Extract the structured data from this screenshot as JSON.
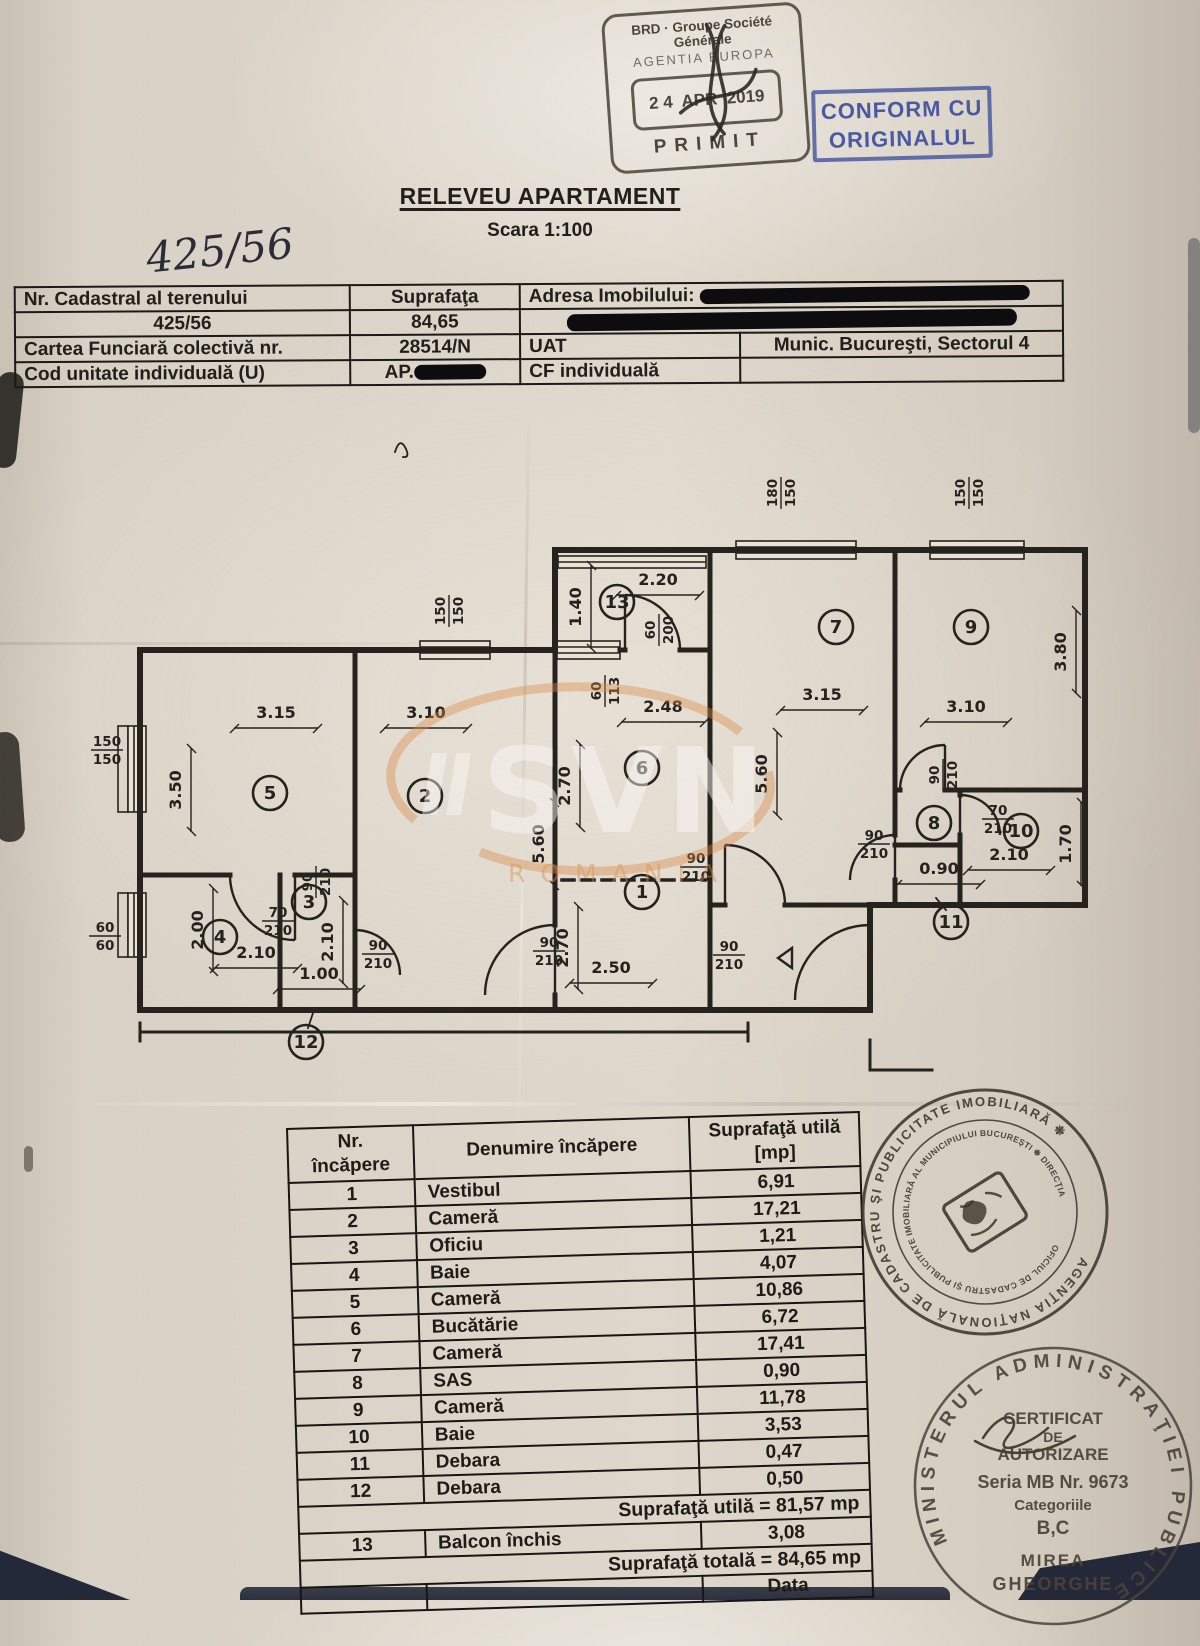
{
  "document": {
    "title": "RELEVEU APARTAMENT",
    "subtitle": "Scara 1:100",
    "handwritten_number": "425/56"
  },
  "stamps": {
    "brd": {
      "org": "BRD · Groupe Société Générale",
      "agency": "AGENTIA EUROPA",
      "date": "2 4  APR  2019",
      "status": "PRIMIT"
    },
    "conform": {
      "line1": "CONFORM CU",
      "line2": "ORIGINALUL",
      "color": "#3c4ea0"
    },
    "ocpi": {
      "outer_text": "AGENŢIA NAŢIONALĂ DE CADASTRU ŞI PUBLICITATE IMOBILIARĂ ❉",
      "inner_text": "OFICIUL DE CADASTRU ŞI PUBLICITATE IMOBILIARĂ AL MUNICIPIULUI BUCUREŞTI ❉ DIRECŢIA"
    },
    "minister": {
      "ring_text": "MINISTERUL ADMINISTRAŢIEI PUBLICE",
      "cert_line1": "CERTIFICAT",
      "cert_line2": "DE",
      "cert_line3": "AUTORIZARE",
      "seria": "Seria MB Nr. 9673",
      "categorii_label": "Categoriile",
      "categorii": "B,C",
      "name1": "MIREA",
      "name2": "GHEORGHE"
    }
  },
  "info_table": {
    "r1c1": "Nr. Cadastral al terenului",
    "r1c2": "Suprafaţa",
    "r1c3": "Adresa Imobilului:",
    "r2c1": "425/56",
    "r2c2": "84,65",
    "r3c1": "Cartea Funciară colectivă nr.",
    "r3c2": "28514/N",
    "r3c3": "UAT",
    "r3c4": "Munic. Bucureşti, Sectorul 4",
    "r4c1": "Cod unitate individuală (U)",
    "r4c2": "AP.",
    "r4c3": "CF individuală",
    "r4c4": ""
  },
  "room_table": {
    "header_nr_1": "Nr.",
    "header_nr_2": "încăpere",
    "header_name": "Denumire încăpere",
    "header_area_1": "Suprafaţă utilă",
    "header_area_2": "[mp]",
    "rows": [
      [
        "1",
        "Vestibul",
        "6,91"
      ],
      [
        "2",
        "Cameră",
        "17,21"
      ],
      [
        "3",
        "Oficiu",
        "1,21"
      ],
      [
        "4",
        "Baie",
        "4,07"
      ],
      [
        "5",
        "Cameră",
        "10,86"
      ],
      [
        "6",
        "Bucătărie",
        "6,72"
      ],
      [
        "7",
        "Cameră",
        "17,41"
      ],
      [
        "8",
        "SAS",
        "0,90"
      ],
      [
        "9",
        "Cameră",
        "11,78"
      ],
      [
        "10",
        "Baie",
        "3,53"
      ],
      [
        "11",
        "Debara",
        "0,47"
      ],
      [
        "12",
        "Debara",
        "0,50"
      ]
    ],
    "subtotal": "Suprafaţă utilă = 81,57 mp",
    "row13": [
      "13",
      "Balcon închis",
      "3,08"
    ],
    "total": "Suprafaţă totală = 84,65 mp",
    "footer": "Data"
  },
  "plan": {
    "watermark": {
      "text": "SVN",
      "sub": "ROMANIA",
      "accent": "#d98a45"
    },
    "rooms": [
      {
        "n": "5",
        "x": 190,
        "y": 363
      },
      {
        "n": "2",
        "x": 345,
        "y": 366
      },
      {
        "n": "6",
        "x": 562,
        "y": 338
      },
      {
        "n": "1",
        "x": 562,
        "y": 462
      },
      {
        "n": "4",
        "x": 140,
        "y": 507
      },
      {
        "n": "3",
        "x": 229,
        "y": 472
      },
      {
        "n": "13",
        "x": 537,
        "y": 172
      },
      {
        "n": "7",
        "x": 756,
        "y": 197
      },
      {
        "n": "9",
        "x": 891,
        "y": 197
      },
      {
        "n": "8",
        "x": 854,
        "y": 393
      },
      {
        "n": "10",
        "x": 941,
        "y": 401
      },
      {
        "n": "11",
        "x": 871,
        "y": 492
      },
      {
        "n": "12",
        "x": 226,
        "y": 612
      }
    ],
    "dims": [
      {
        "t": "3.15",
        "x": 196,
        "y": 288,
        "r": 0,
        "l": 1
      },
      {
        "t": "3.10",
        "x": 346,
        "y": 288,
        "r": 0,
        "l": 1
      },
      {
        "t": "2.48",
        "x": 583,
        "y": 282,
        "r": 0,
        "l": 1
      },
      {
        "t": "3.15",
        "x": 742,
        "y": 270,
        "r": 0,
        "l": 1
      },
      {
        "t": "3.10",
        "x": 886,
        "y": 282,
        "r": 0,
        "l": 1
      },
      {
        "t": "2.20",
        "x": 578,
        "y": 155,
        "r": 0,
        "l": 1
      },
      {
        "t": "2.50",
        "x": 531,
        "y": 543,
        "r": 0,
        "l": 1
      },
      {
        "t": "2.10",
        "x": 176,
        "y": 528,
        "r": 0,
        "l": 1
      },
      {
        "t": "1.00",
        "x": 239,
        "y": 549,
        "r": 0,
        "l": 1
      },
      {
        "t": "0.90",
        "x": 859,
        "y": 444,
        "r": 0,
        "l": 1
      },
      {
        "t": "2.10",
        "x": 929,
        "y": 430,
        "r": 0,
        "l": 1
      },
      {
        "t": "3.50",
        "x": 101,
        "y": 360,
        "r": -90,
        "l": 1
      },
      {
        "t": "5.60",
        "x": 464,
        "y": 414,
        "r": -90,
        "l": 1
      },
      {
        "t": "2.70",
        "x": 490,
        "y": 356,
        "r": -90,
        "l": 1
      },
      {
        "t": "2.70",
        "x": 488,
        "y": 518,
        "r": -90,
        "l": 1
      },
      {
        "t": "2.00",
        "x": 123,
        "y": 500,
        "r": -90,
        "l": 1
      },
      {
        "t": "2.10",
        "x": 253,
        "y": 512,
        "r": -90,
        "l": 1
      },
      {
        "t": "1.40",
        "x": 501,
        "y": 177,
        "r": -90,
        "l": 1
      },
      {
        "t": "5.60",
        "x": 687,
        "y": 344,
        "r": -90,
        "l": 1
      },
      {
        "t": "3.80",
        "x": 986,
        "y": 222,
        "r": -90,
        "l": 1
      },
      {
        "t": "1.70",
        "x": 991,
        "y": 414,
        "r": -90,
        "l": 1
      }
    ],
    "fracs": [
      {
        "a": "150",
        "b": "150",
        "x": 27,
        "y": 320,
        "r": 0
      },
      {
        "a": "60",
        "b": "60",
        "x": 25,
        "y": 506,
        "r": 0
      },
      {
        "a": "150",
        "b": "150",
        "x": 369,
        "y": 181,
        "r": -90
      },
      {
        "a": "180",
        "b": "150",
        "x": 701,
        "y": 63,
        "r": -90
      },
      {
        "a": "150",
        "b": "150",
        "x": 889,
        "y": 63,
        "r": -90
      },
      {
        "a": "60",
        "b": "113",
        "x": 525,
        "y": 261,
        "r": -90
      },
      {
        "a": "60",
        "b": "200",
        "x": 579,
        "y": 200,
        "r": -90
      },
      {
        "a": "90",
        "b": "210",
        "x": 236,
        "y": 452,
        "r": -90
      },
      {
        "a": "70",
        "b": "210",
        "x": 198,
        "y": 491,
        "r": 0
      },
      {
        "a": "90",
        "b": "210",
        "x": 298,
        "y": 524,
        "r": 0
      },
      {
        "a": "90",
        "b": "210",
        "x": 469,
        "y": 521,
        "r": 0
      },
      {
        "a": "90",
        "b": "210",
        "x": 616,
        "y": 437,
        "r": 0
      },
      {
        "a": "90",
        "b": "210",
        "x": 649,
        "y": 525,
        "r": 0
      },
      {
        "a": "90",
        "b": "210",
        "x": 863,
        "y": 345,
        "r": -90
      },
      {
        "a": "90",
        "b": "210",
        "x": 794,
        "y": 414,
        "r": 0
      },
      {
        "a": "70",
        "b": "210",
        "x": 918,
        "y": 389,
        "r": 0
      }
    ]
  }
}
